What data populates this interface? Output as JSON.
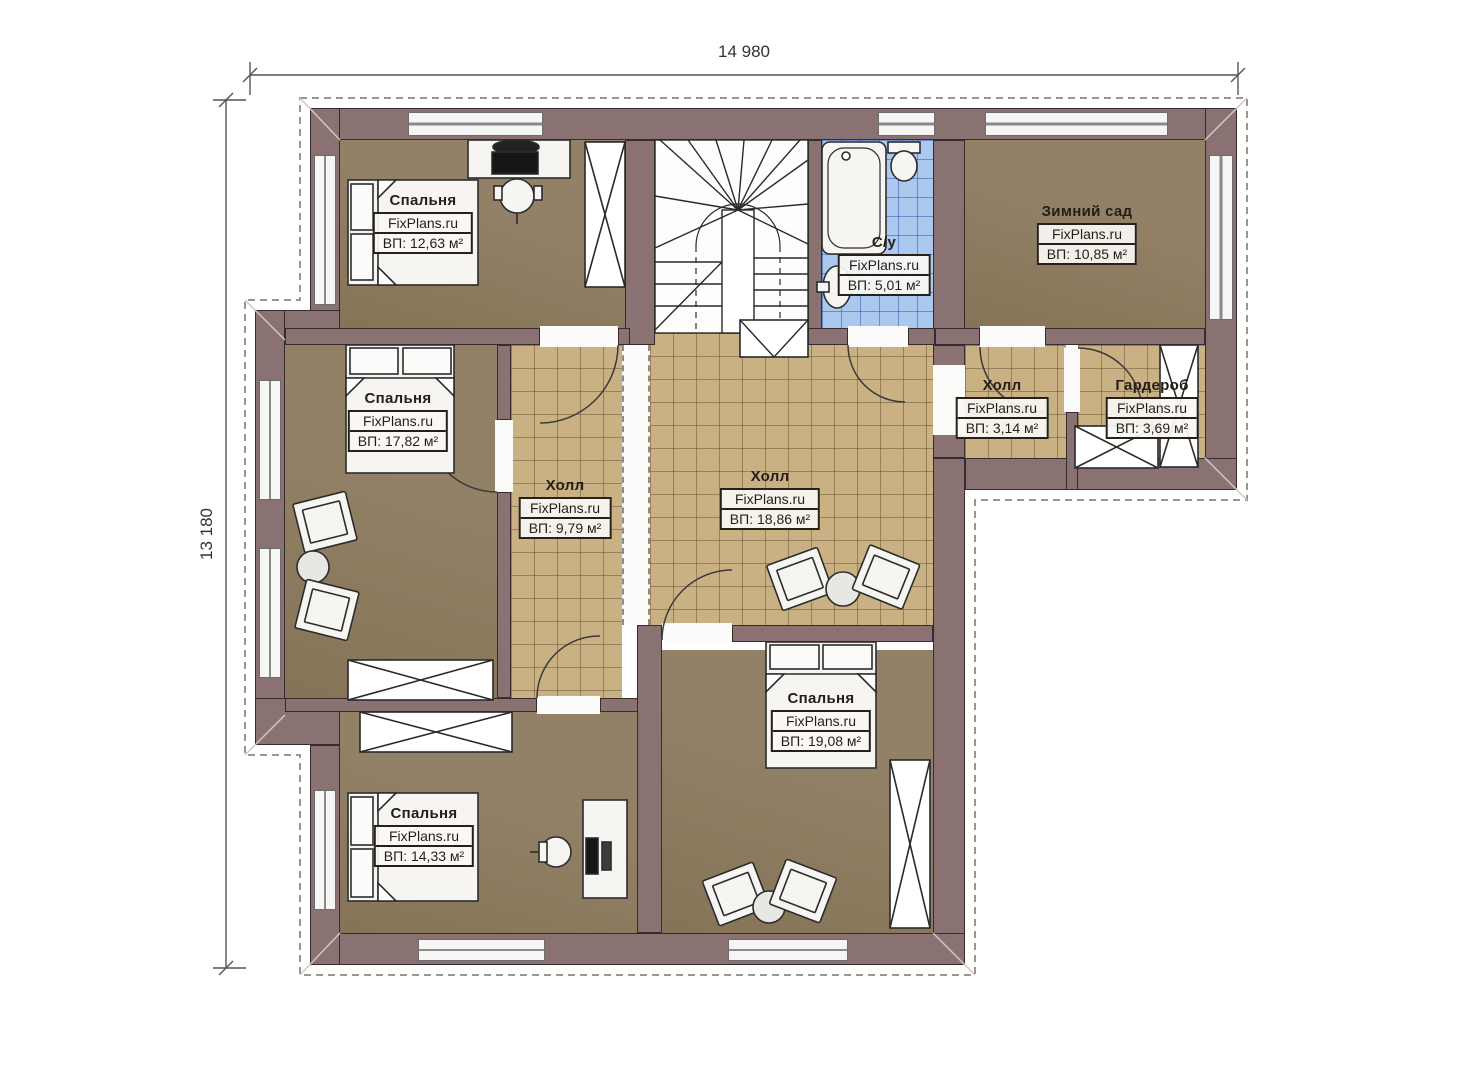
{
  "plan": {
    "type": "floor-plan"
  },
  "dimensions": {
    "width_total": "14 980",
    "depth_total": "13 180"
  },
  "watermark": "FixPlans.ru",
  "rooms": [
    {
      "id": "bedroom-top-left",
      "name": "Спальня",
      "area": "ВП: 12,63 м²"
    },
    {
      "id": "bedroom-mid-left",
      "name": "Спальня",
      "area": "ВП: 17,82 м²"
    },
    {
      "id": "bedroom-bottom-left",
      "name": "Спальня",
      "area": "ВП: 14,33 м²"
    },
    {
      "id": "bedroom-bottom-mid",
      "name": "Спальня",
      "area": "ВП: 19,08 м²"
    },
    {
      "id": "winter-garden",
      "name": "Зимний сад",
      "area": "ВП: 10,85 м²"
    },
    {
      "id": "bathroom",
      "name": "С/у",
      "area": "ВП: 5,01 м²"
    },
    {
      "id": "hall-left",
      "name": "Холл",
      "area": "ВП: 9,79 м²"
    },
    {
      "id": "hall-center",
      "name": "Холл",
      "area": "ВП: 18,86 м²"
    },
    {
      "id": "hall-small",
      "name": "Холл",
      "area": "ВП: 3,14 м²"
    },
    {
      "id": "wardrobe",
      "name": "Гардероб",
      "area": "ВП: 3,69 м²"
    }
  ],
  "colors": {
    "wall": "#8a7172",
    "floor-room": "#8c7a5e",
    "floor-hall": "#c9b183",
    "floor-bath": "#abc9ee",
    "ink": "#2c2c2c",
    "furn": "#f6f5f2"
  }
}
